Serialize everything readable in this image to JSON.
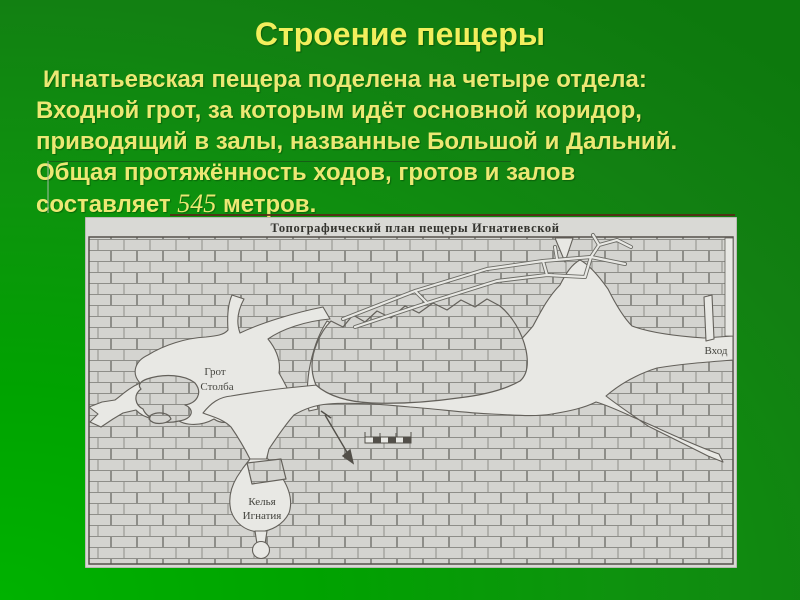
{
  "slide": {
    "title": "Строение пещеры",
    "body": {
      "line1": "Игнатьевская пещера поделена на четыре отдела:",
      "line2": "Входной грот, за которым идёт основной коридор,",
      "line3": "приводящий в залы, названные Большой и Дальний.",
      "line4": "Общая протяжённость ходов, гротов и залов",
      "line5_prefix": "составляет ",
      "line5_number": "545",
      "line5_suffix": " метров."
    },
    "colors": {
      "background_green_dark": "#0d790d",
      "background_green_bright": "#00b200",
      "text_yellow": "#ece874",
      "underline_dark_red": "#5c2418"
    }
  },
  "map": {
    "title": "Топографический план пещеры Игнатиевской",
    "labels": {
      "grot_line1": "Грот",
      "grot_line2": "Столба",
      "kelya_line1": "Келья",
      "kelya_line2": "Игнатия",
      "entrance": "Вход"
    },
    "colors": {
      "paper": "#d9d9d5",
      "passage": "#e8e8e4",
      "ink": "#55514b"
    }
  }
}
